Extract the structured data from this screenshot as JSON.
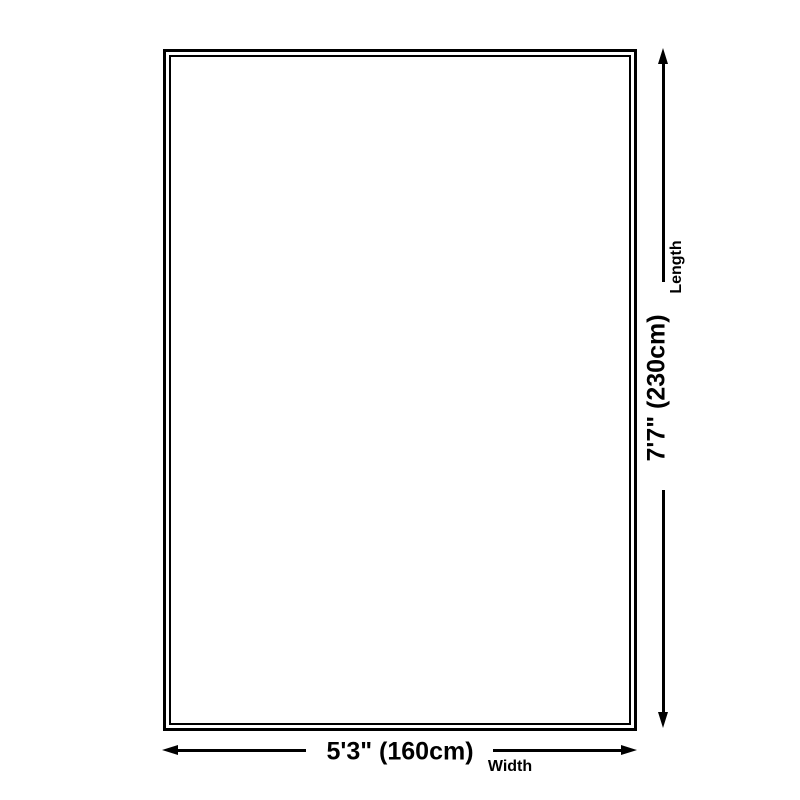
{
  "colors": {
    "line": "#000000",
    "background": "#ffffff",
    "text": "#000000"
  },
  "diagram": {
    "type": "product-dimensions",
    "length": {
      "label": "Length",
      "value": "7'7\" (230cm)"
    },
    "width": {
      "label": "Width",
      "value": "5'3\" (160cm)"
    },
    "icons": {
      "arrow_up": "arrow-up-icon",
      "arrow_down": "arrow-down-icon",
      "arrow_left": "arrow-left-icon",
      "arrow_right": "arrow-right-icon"
    }
  }
}
